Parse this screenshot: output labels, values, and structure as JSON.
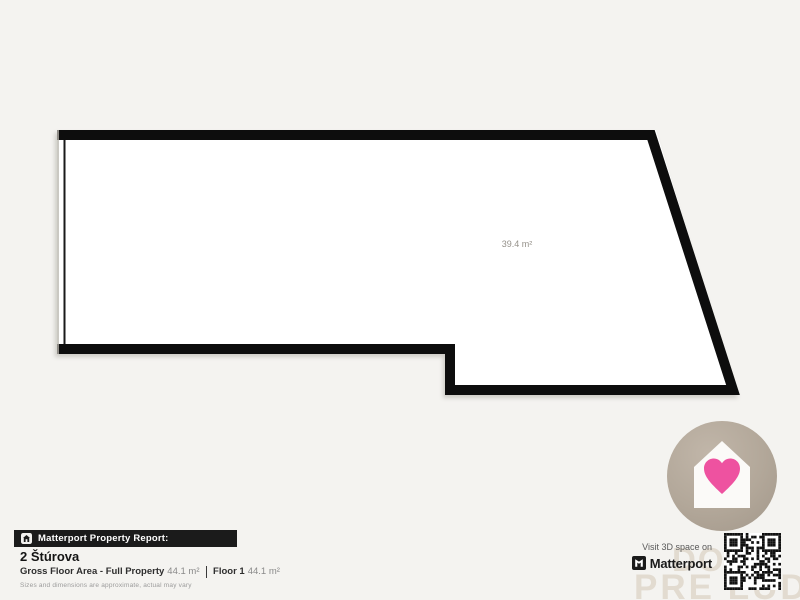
{
  "page": {
    "background_color": "#f4f3f0"
  },
  "floor_plan": {
    "area_label": "39.4 m²",
    "wall_color": "#0d0d0d",
    "interior_color": "#ffffff"
  },
  "report_bar": {
    "label": "Matterport Property Report:",
    "background_color": "#1b1b1b",
    "icon": "house-icon"
  },
  "property": {
    "title": "2 Štúrova",
    "gross_floor_area_label": "Gross Floor Area - Full Property",
    "gross_floor_area_value": "44.1 m²",
    "floor_label": "Floor 1",
    "floor_value": "44.1 m²",
    "disclaimer": "Sizes and dimensions are approximate, actual may vary"
  },
  "visit": {
    "text": "Visit 3D space on",
    "brand": "Matterport",
    "icon": "matterport-logo-icon"
  },
  "badge": {
    "icon": "house-heart-icon",
    "circle_color": "#b2a799",
    "house_color": "#fbfaf8",
    "heart_color": "#ee52a0"
  },
  "watermark": {
    "line1": "DO",
    "line2": "PRE ĽUDÍ",
    "color": "#e2dbd0"
  },
  "qr": {
    "icon": "qr-code"
  }
}
